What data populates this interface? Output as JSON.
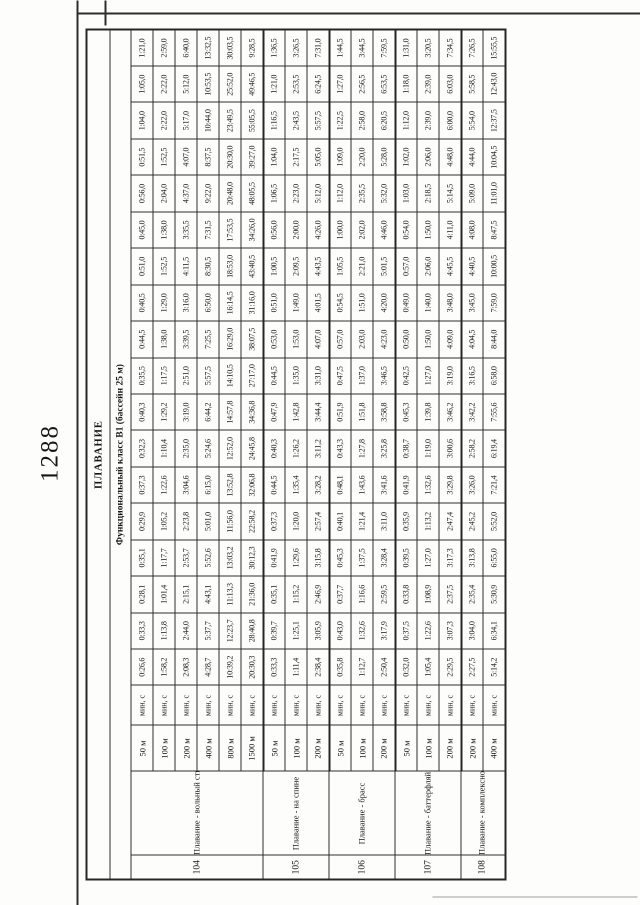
{
  "page": {
    "number": "1288"
  },
  "table": {
    "title": "ПЛАВАНИЕ",
    "subtitle": "Функциональный класс B1 (бассейн 25 м)",
    "unit_label": "мин, с",
    "groups": [
      {
        "no": "104",
        "sport": "Плавание - вольный стиль",
        "rows": [
          {
            "distance": "50 м",
            "values": [
              "0:26,6",
              "0:33,3",
              "0:28,1",
              "0:35,1",
              "0:29,9",
              "0:37,3",
              "0:32,3",
              "0:40,3",
              "0:35,5",
              "0:44,5",
              "0:40,5",
              "0:51,0",
              "0:45,0",
              "0:56,0",
              "0:51,5",
              "1:04,0",
              "1:05,0",
              "1:21,0"
            ]
          },
          {
            "distance": "100 м",
            "values": [
              "1:58,2",
              "1:13,8",
              "1:01,4",
              "1:17,7",
              "1:05,2",
              "1:22,6",
              "1:10,4",
              "1:29,2",
              "1:17,5",
              "1:38,0",
              "1:29,0",
              "1:52,5",
              "1:38,0",
              "2:04,0",
              "1:52,5",
              "2:22,0",
              "2:22,0",
              "2:59,0"
            ]
          },
          {
            "distance": "200 м",
            "values": [
              "2:08,3",
              "2:44,0",
              "2:15,1",
              "2:53,7",
              "2:23,8",
              "3:04,6",
              "2:35,0",
              "3:19,0",
              "2:51,0",
              "3:39,5",
              "3:16,0",
              "4:11,5",
              "3:35,5",
              "4:37,0",
              "4:07,0",
              "5:17,0",
              "5:12,0",
              "6:40,0"
            ]
          },
          {
            "distance": "400 м",
            "values": [
              "4:28,7",
              "5:37,7",
              "4:43,1",
              "5:52,6",
              "5:01,0",
              "6:15,0",
              "5:24,6",
              "6:44,2",
              "5:57,5",
              "7:25,5",
              "6:50,0",
              "8:30,5",
              "7:31,5",
              "9:22,0",
              "8:37,5",
              "10:44,0",
              "10:53,5",
              "13:32,5"
            ]
          },
          {
            "distance": "800 м",
            "values": [
              "10:39,2",
              "12:23,7",
              "11:13,3",
              "13:03,2",
              "11:56,0",
              "13:52,8",
              "12:52,0",
              "14:57,8",
              "14:10,5",
              "16:29,0",
              "16:14,5",
              "18:53,0",
              "17:53,5",
              "20:48,0",
              "20:30,0",
              "23:49,5",
              "25:52,0",
              "30:03,5"
            ]
          },
          {
            "distance": "1500 м",
            "values": [
              "20:30,3",
              "28:40,8",
              "21:36,0",
              "30:12,3",
              "22:58,2",
              "32:06,8",
              "24:45,8",
              "34:36,8",
              "27:17,0",
              "38:07,5",
              "31:16,0",
              "43:40,5",
              "34:26,0",
              "48:05,5",
              "39:27,0",
              "55:05,5",
              "49:46,5",
              "9:28,5"
            ]
          }
        ]
      },
      {
        "no": "105",
        "sport": "Плавание - на спине",
        "rows": [
          {
            "distance": "50 м",
            "values": [
              "0:33,3",
              "0:39,7",
              "0:35,1",
              "0:41,9",
              "0:37,3",
              "0:44,5",
              "0:40,3",
              "0:47,9",
              "0:44,5",
              "0:53,0",
              "0:51,0",
              "1:00,5",
              "0:56,0",
              "1:06,5",
              "1:04,0",
              "1:16,5",
              "1:21,0",
              "1:36,5"
            ]
          },
          {
            "distance": "100 м",
            "values": [
              "1:11,4",
              "1:25,1",
              "1:15,2",
              "1:29,6",
              "1:20,0",
              "1:35,4",
              "1:26,2",
              "1:42,8",
              "1:35,0",
              "1:53,0",
              "1:49,0",
              "2:09,5",
              "2:00,0",
              "2:23,0",
              "2:17,5",
              "2:43,5",
              "2:53,5",
              "3:26,5"
            ]
          },
          {
            "distance": "200 м",
            "values": [
              "2:38,4",
              "3:05,9",
              "2:46,9",
              "3:15,8",
              "2:57,4",
              "3:28,2",
              "3:11,2",
              "3:44,4",
              "3:31,0",
              "4:07,0",
              "4:01,5",
              "4:43,5",
              "4:26,0",
              "5:12,0",
              "5:05,0",
              "5:57,5",
              "6:24,5",
              "7:31,0"
            ]
          }
        ]
      },
      {
        "no": "106",
        "sport": "Плавание - брасс",
        "rows": [
          {
            "distance": "50 м",
            "values": [
              "0:35,8",
              "0:43,0",
              "0:37,7",
              "0:45,3",
              "0:40,1",
              "0:48,1",
              "0:43,3",
              "0:51,9",
              "0:47,5",
              "0:57,0",
              "0:54,5",
              "1:05,5",
              "1:00,0",
              "1:12,0",
              "1:09,0",
              "1:22,5",
              "1:27,0",
              "1:44,5"
            ]
          },
          {
            "distance": "100 м",
            "values": [
              "1:12,7",
              "1:32,6",
              "1:16,6",
              "1:37,5",
              "1:21,4",
              "1:43,6",
              "1:27,8",
              "1:51,8",
              "1:37,0",
              "2:03,0",
              "1:51,0",
              "2:21,0",
              "2:02,0",
              "2:35,5",
              "2:20,0",
              "2:58,0",
              "2:56,5",
              "3:44,5"
            ]
          },
          {
            "distance": "200 м",
            "values": [
              "2:50,4",
              "3:17,9",
              "2:59,5",
              "3:28,4",
              "3:11,0",
              "3:41,6",
              "3:25,8",
              "3:58,8",
              "3:46,5",
              "4:23,0",
              "4:20,0",
              "5:01,5",
              "4:46,0",
              "5:32,0",
              "5:28,0",
              "6:20,5",
              "6:53,5",
              "7:59,5"
            ]
          }
        ]
      },
      {
        "no": "107",
        "sport": "Плавание - баттерфляй",
        "rows": [
          {
            "distance": "50 м",
            "values": [
              "0:32,0",
              "0:37,5",
              "0:33,8",
              "0:39,5",
              "0:35,9",
              "0:41,9",
              "0:38,7",
              "0:45,3",
              "0:42,5",
              "0:50,0",
              "0:49,0",
              "0:57,0",
              "0:54,0",
              "1:03,0",
              "1:02,0",
              "1:12,0",
              "1:18,0",
              "1:31,0"
            ]
          },
          {
            "distance": "100 м",
            "values": [
              "1:05,4",
              "1:22,6",
              "1:08,9",
              "1:27,0",
              "1:13,2",
              "1:32,6",
              "1:19,0",
              "1:39,8",
              "1:27,0",
              "1:50,0",
              "1:40,0",
              "2:06,0",
              "1:50,0",
              "2:18,5",
              "2:06,0",
              "2:39,0",
              "2:39,0",
              "3:20,5"
            ]
          },
          {
            "distance": "200 м",
            "values": [
              "2:29,5",
              "3:07,3",
              "2:37,5",
              "3:17,3",
              "2:47,4",
              "3:29,8",
              "3:00,6",
              "3:46,2",
              "3:19,0",
              "4:09,0",
              "3:48,0",
              "4:45,5",
              "4:11,0",
              "5:14,5",
              "4:48,0",
              "6:00,0",
              "6:03,0",
              "7:34,5"
            ]
          }
        ]
      },
      {
        "no": "108",
        "sport": "Плавание - комплексное",
        "rows": [
          {
            "distance": "200 м",
            "values": [
              "2:27,5",
              "3:04,0",
              "2:35,4",
              "3:13,8",
              "2:45,2",
              "3:26,0",
              "2:58,2",
              "3:42,2",
              "3:16,5",
              "4:04,5",
              "3:45,0",
              "4:40,5",
              "4:08,0",
              "5:09,0",
              "4:44,0",
              "5:54,0",
              "5:58,5",
              "7:26,5"
            ]
          },
          {
            "distance": "400 м",
            "values": [
              "5:14,2",
              "6:34,1",
              "5:30,9",
              "6:55,0",
              "5:52,0",
              "7:21,4",
              "6:19,4",
              "7:55,6",
              "6:58,0",
              "8:44,0",
              "7:59,0",
              "10:00,5",
              "8:47,5",
              "11:01,0",
              "10:04,5",
              "12:37,5",
              "12:43,0",
              "15:55,5"
            ]
          }
        ]
      }
    ]
  }
}
